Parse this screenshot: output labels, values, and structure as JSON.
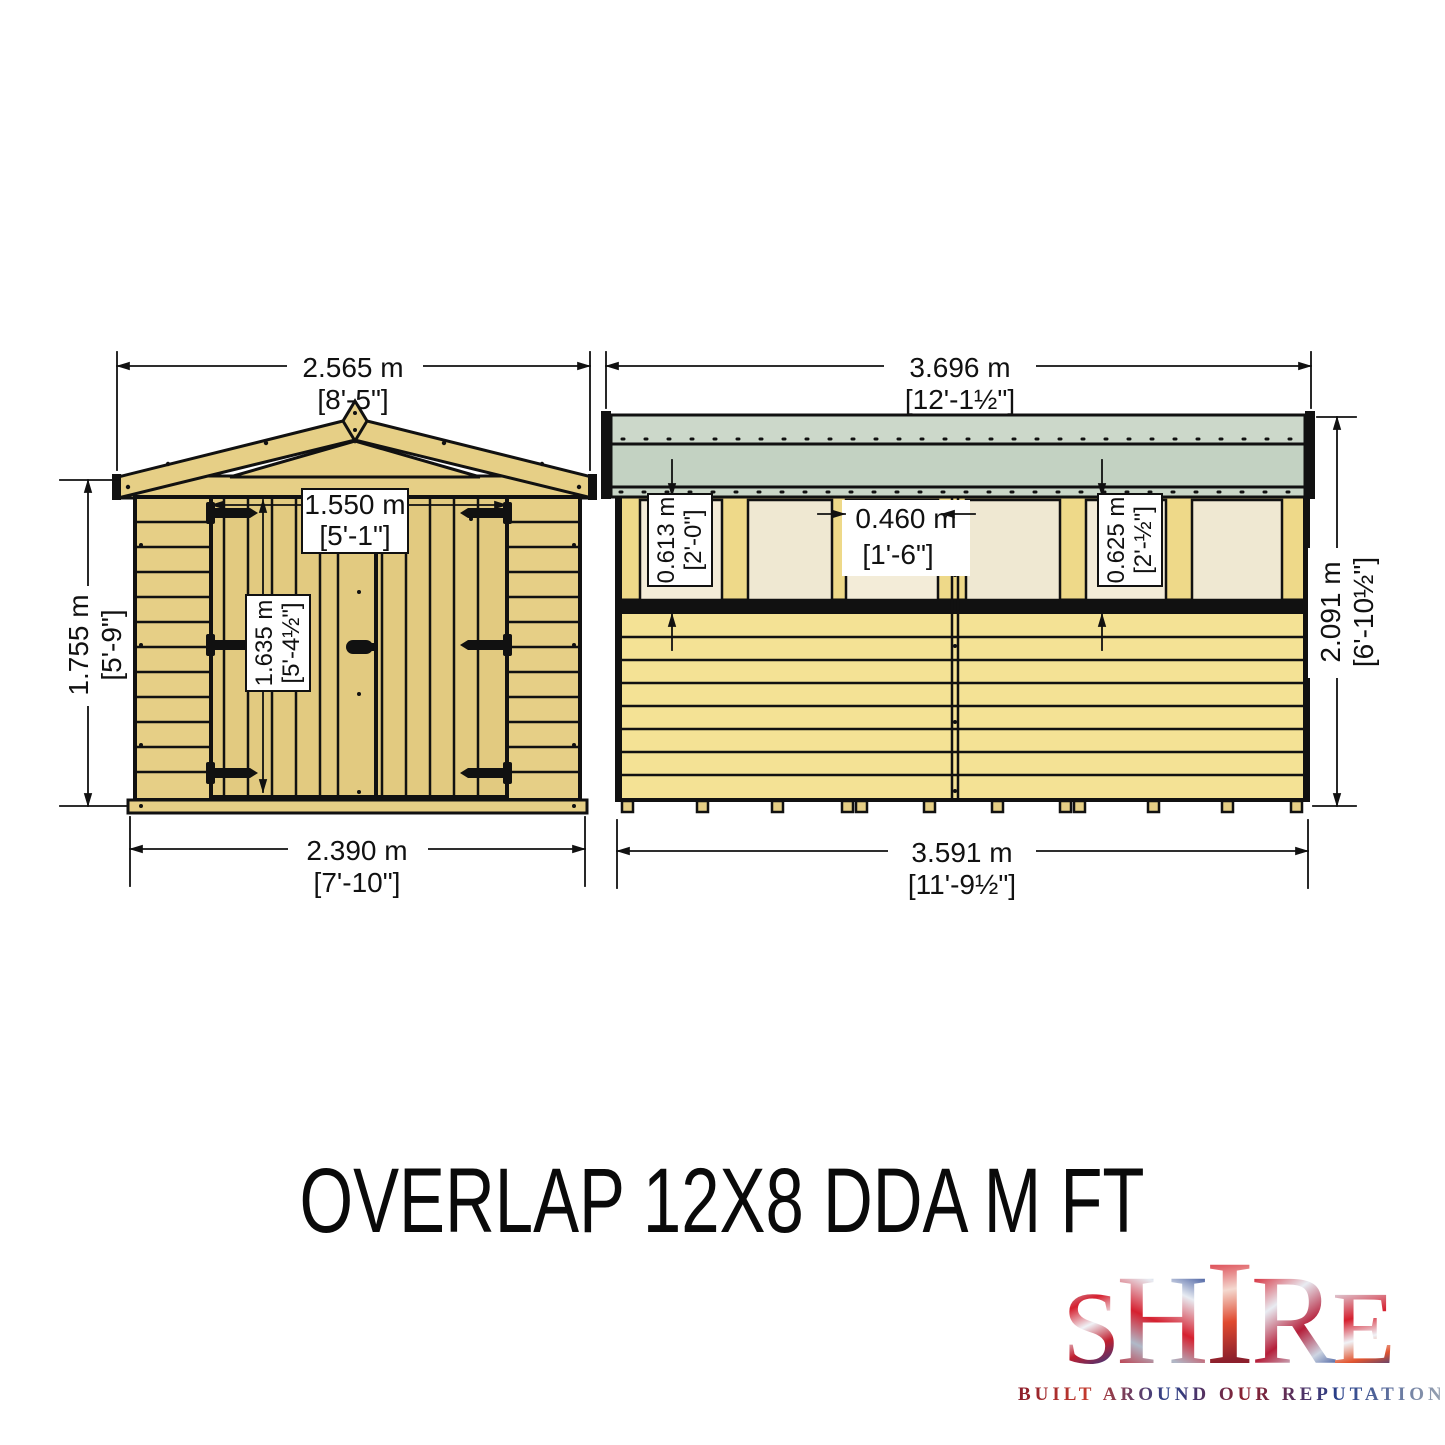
{
  "title": "OVERLAP 12X8 DDA M FT",
  "logo": {
    "letters": [
      "S",
      "H",
      "I",
      "R",
      "E"
    ],
    "tagline": "BUILT AROUND OUR REPUTATION"
  },
  "front_view": {
    "dims": {
      "roof_width_m": "2.565 m",
      "roof_width_ft": "[8'-5\"]",
      "wall_height_m": "1.755 m",
      "wall_height_ft": "[5'-9\"]",
      "door_width_m": "1.550 m",
      "door_width_ft": "[5'-1\"]",
      "door_height_m": "1.635 m",
      "door_height_ft": "[5'-4½\"]",
      "base_width_m": "2.390 m",
      "base_width_ft": "[7'-10\"]"
    }
  },
  "side_view": {
    "dims": {
      "roof_length_m": "3.696 m",
      "roof_length_ft": "[12'-1½\"]",
      "window_height_left_m": "0.613 m",
      "window_height_left_ft": "[2'-0\"]",
      "window_width_m": "0.460 m",
      "window_width_ft": "[1'-6\"]",
      "window_height_right_m": "0.625 m",
      "window_height_right_ft": "[2'-½\"]",
      "wall_height_m": "2.091 m",
      "wall_height_ft": "[6'-10½\"]",
      "base_length_m": "3.591 m",
      "base_length_ft": "[11'-9½\"]"
    }
  },
  "colors": {
    "wood": "#e6cf86",
    "wood_light": "#f4e295",
    "stud_wood": "#eed989",
    "window_cream": "#f3ecd8",
    "roof_green_top": "#ccd8ca",
    "roof_green_main": "#c3d2c2",
    "roof_green_strip": "#c9d6c7",
    "outline": "#111111",
    "logo_red": "#d6202f",
    "logo_blue": "#1f3b8c"
  }
}
